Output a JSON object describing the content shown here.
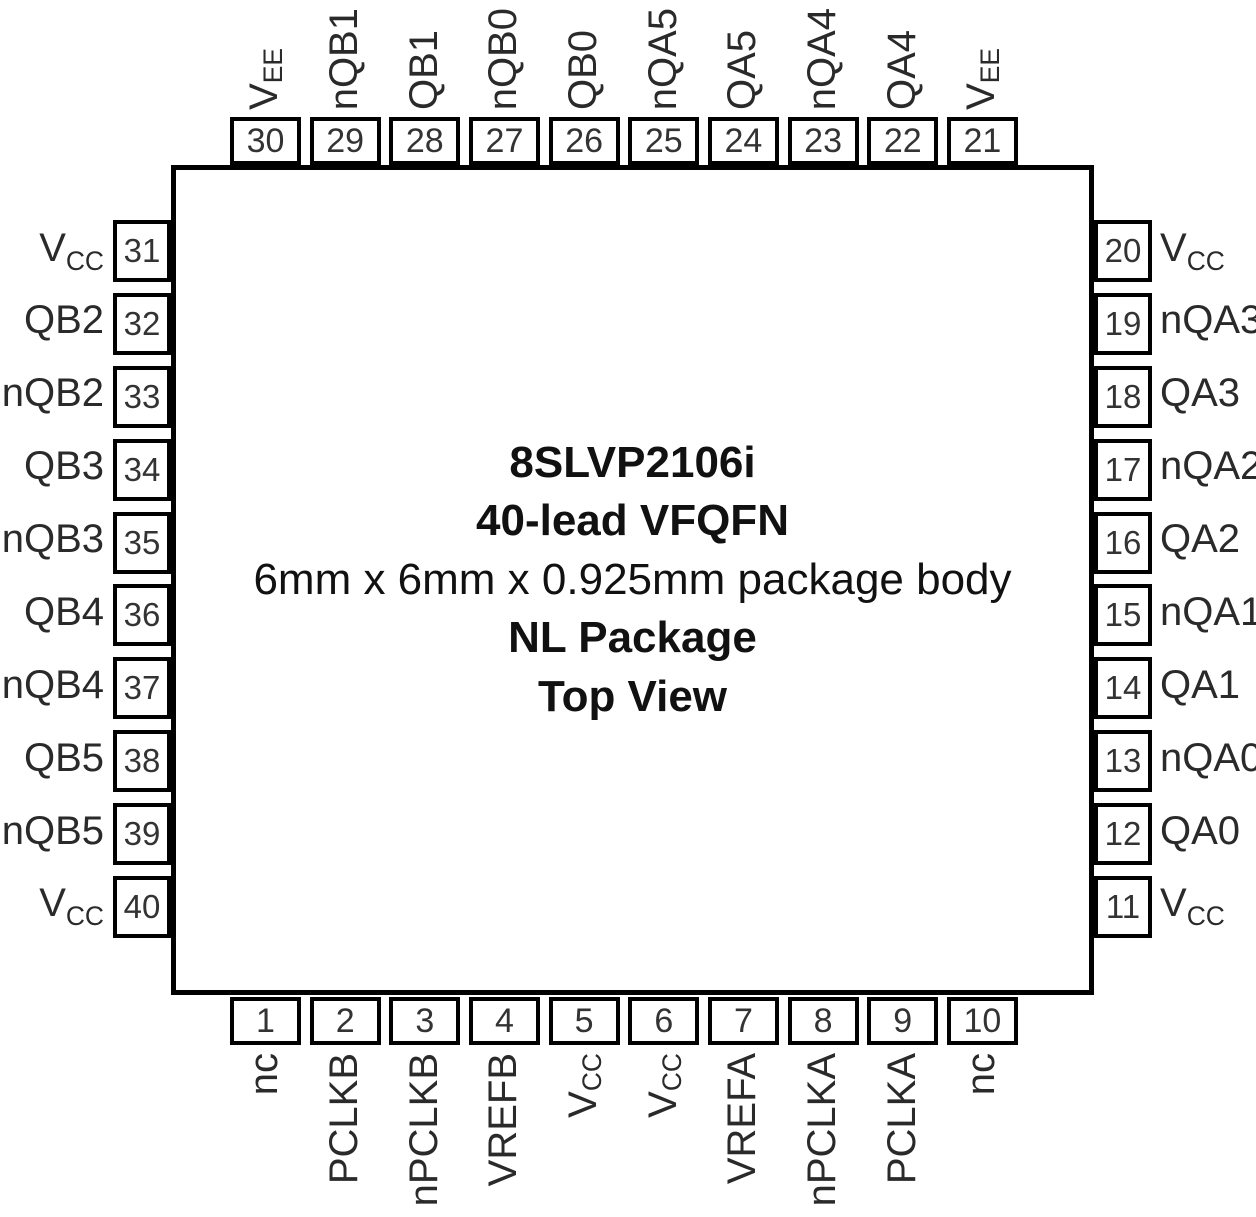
{
  "diagram": {
    "title": "8SLVP2106i",
    "package_type": "40-lead VFQFN",
    "body_size": "6mm x 6mm x 0.925mm package body",
    "package_name": "NL Package",
    "view": "Top View"
  },
  "pins": {
    "top": [
      {
        "num": "30",
        "base": "V",
        "sub": "EE"
      },
      {
        "num": "29",
        "base": "nQB1",
        "sub": ""
      },
      {
        "num": "28",
        "base": "QB1",
        "sub": ""
      },
      {
        "num": "27",
        "base": "nQB0",
        "sub": ""
      },
      {
        "num": "26",
        "base": "QB0",
        "sub": ""
      },
      {
        "num": "25",
        "base": "nQA5",
        "sub": ""
      },
      {
        "num": "24",
        "base": "QA5",
        "sub": ""
      },
      {
        "num": "23",
        "base": "nQA4",
        "sub": ""
      },
      {
        "num": "22",
        "base": "QA4",
        "sub": ""
      },
      {
        "num": "21",
        "base": "V",
        "sub": "EE"
      }
    ],
    "left": [
      {
        "num": "31",
        "base": "V",
        "sub": "CC"
      },
      {
        "num": "32",
        "base": "QB2",
        "sub": ""
      },
      {
        "num": "33",
        "base": "nQB2",
        "sub": ""
      },
      {
        "num": "34",
        "base": "QB3",
        "sub": ""
      },
      {
        "num": "35",
        "base": "nQB3",
        "sub": ""
      },
      {
        "num": "36",
        "base": "QB4",
        "sub": ""
      },
      {
        "num": "37",
        "base": "nQB4",
        "sub": ""
      },
      {
        "num": "38",
        "base": "QB5",
        "sub": ""
      },
      {
        "num": "39",
        "base": "nQB5",
        "sub": ""
      },
      {
        "num": "40",
        "base": "V",
        "sub": "CC"
      }
    ],
    "right": [
      {
        "num": "20",
        "base": "V",
        "sub": "CC"
      },
      {
        "num": "19",
        "base": "nQA3",
        "sub": ""
      },
      {
        "num": "18",
        "base": "QA3",
        "sub": ""
      },
      {
        "num": "17",
        "base": "nQA2",
        "sub": ""
      },
      {
        "num": "16",
        "base": "QA2",
        "sub": ""
      },
      {
        "num": "15",
        "base": "nQA1",
        "sub": ""
      },
      {
        "num": "14",
        "base": "QA1",
        "sub": ""
      },
      {
        "num": "13",
        "base": "nQA0",
        "sub": ""
      },
      {
        "num": "12",
        "base": "QA0",
        "sub": ""
      },
      {
        "num": "11",
        "base": "V",
        "sub": "CC"
      }
    ],
    "bottom": [
      {
        "num": "1",
        "base": "nc",
        "sub": ""
      },
      {
        "num": "2",
        "base": "PCLKB",
        "sub": ""
      },
      {
        "num": "3",
        "base": "nPCLKB",
        "sub": ""
      },
      {
        "num": "4",
        "base": "VREFB",
        "sub": ""
      },
      {
        "num": "5",
        "base": "V",
        "sub": "CC"
      },
      {
        "num": "6",
        "base": "V",
        "sub": "CC"
      },
      {
        "num": "7",
        "base": "VREFA",
        "sub": ""
      },
      {
        "num": "8",
        "base": "nPCLKA",
        "sub": ""
      },
      {
        "num": "9",
        "base": "PCLKA",
        "sub": ""
      },
      {
        "num": "10",
        "base": "nc",
        "sub": ""
      }
    ]
  }
}
